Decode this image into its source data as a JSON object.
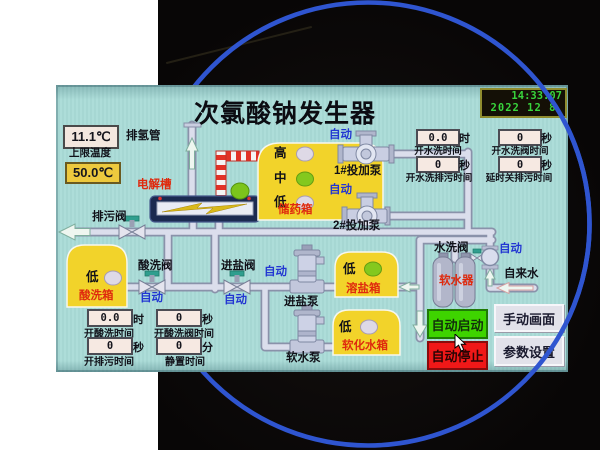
{
  "colors": {
    "page_bg": "#ffffff",
    "photo_bg": "#0c0a0a",
    "ring_blue": "#2f55d0",
    "screen_bg": "#a9dbd7",
    "tank_yellow": "#f2d32a",
    "auto_blue": "#2336d2",
    "label_red": "#df2a0e",
    "btn_start_green": "#3ed400",
    "btn_stop_red": "#f01818",
    "clock_green": "#38d43c",
    "indicator_green": "#84c81e",
    "limit_box_yellow": "#edc93e"
  },
  "screen": {
    "title": "次氯酸钠发生器",
    "clock": {
      "time": "14:33:07",
      "date": "2022 12 8"
    },
    "temp": {
      "current": "11.1℃",
      "limit_label": "上限温度",
      "limit_value": "50.0℃"
    },
    "auto_label": "自动",
    "levels": {
      "high": "高",
      "mid": "中",
      "low": "低"
    },
    "devices": {
      "exhaust_pipe": "排氢管",
      "electrolyzer": "电解槽",
      "drain_valve": "排污阀",
      "acid_tank": "酸洗箱",
      "acid_valve": "酸洗阀",
      "storage_tank": "储药箱",
      "dosing_pump_1": "1#投加泵",
      "dosing_pump_2": "2#投加泵",
      "salt_valve": "进盐阀",
      "salt_pump": "进盐泵",
      "salt_tank": "溶盐箱",
      "soft_pump": "软水泵",
      "soft_tank": "软化水箱",
      "softener": "软水器",
      "wash_valve": "水洗阀",
      "tap_water": "自来水"
    },
    "timers_right": [
      {
        "value": "0.0",
        "unit": "时",
        "label": "开水洗时间"
      },
      {
        "value": "0",
        "unit": "秒",
        "label": "开水洗阀时间"
      },
      {
        "value": "0",
        "unit": "秒",
        "label": "开水洗排污时间"
      },
      {
        "value": "0",
        "unit": "秒",
        "label": "延时关排污时间"
      }
    ],
    "timers_left": [
      {
        "value": "0.0",
        "unit": "时",
        "label": "开酸洗时间"
      },
      {
        "value": "0",
        "unit": "秒",
        "label": "开酸洗阀时间"
      },
      {
        "value": "0",
        "unit": "秒",
        "label": "开排污时间"
      },
      {
        "value": "0",
        "unit": "分",
        "label": "静置时间"
      }
    ],
    "buttons": {
      "auto_start": "自动启动",
      "auto_stop": "自动停止",
      "manual_screen": "手动画面",
      "param_settings": "参数设置"
    }
  }
}
